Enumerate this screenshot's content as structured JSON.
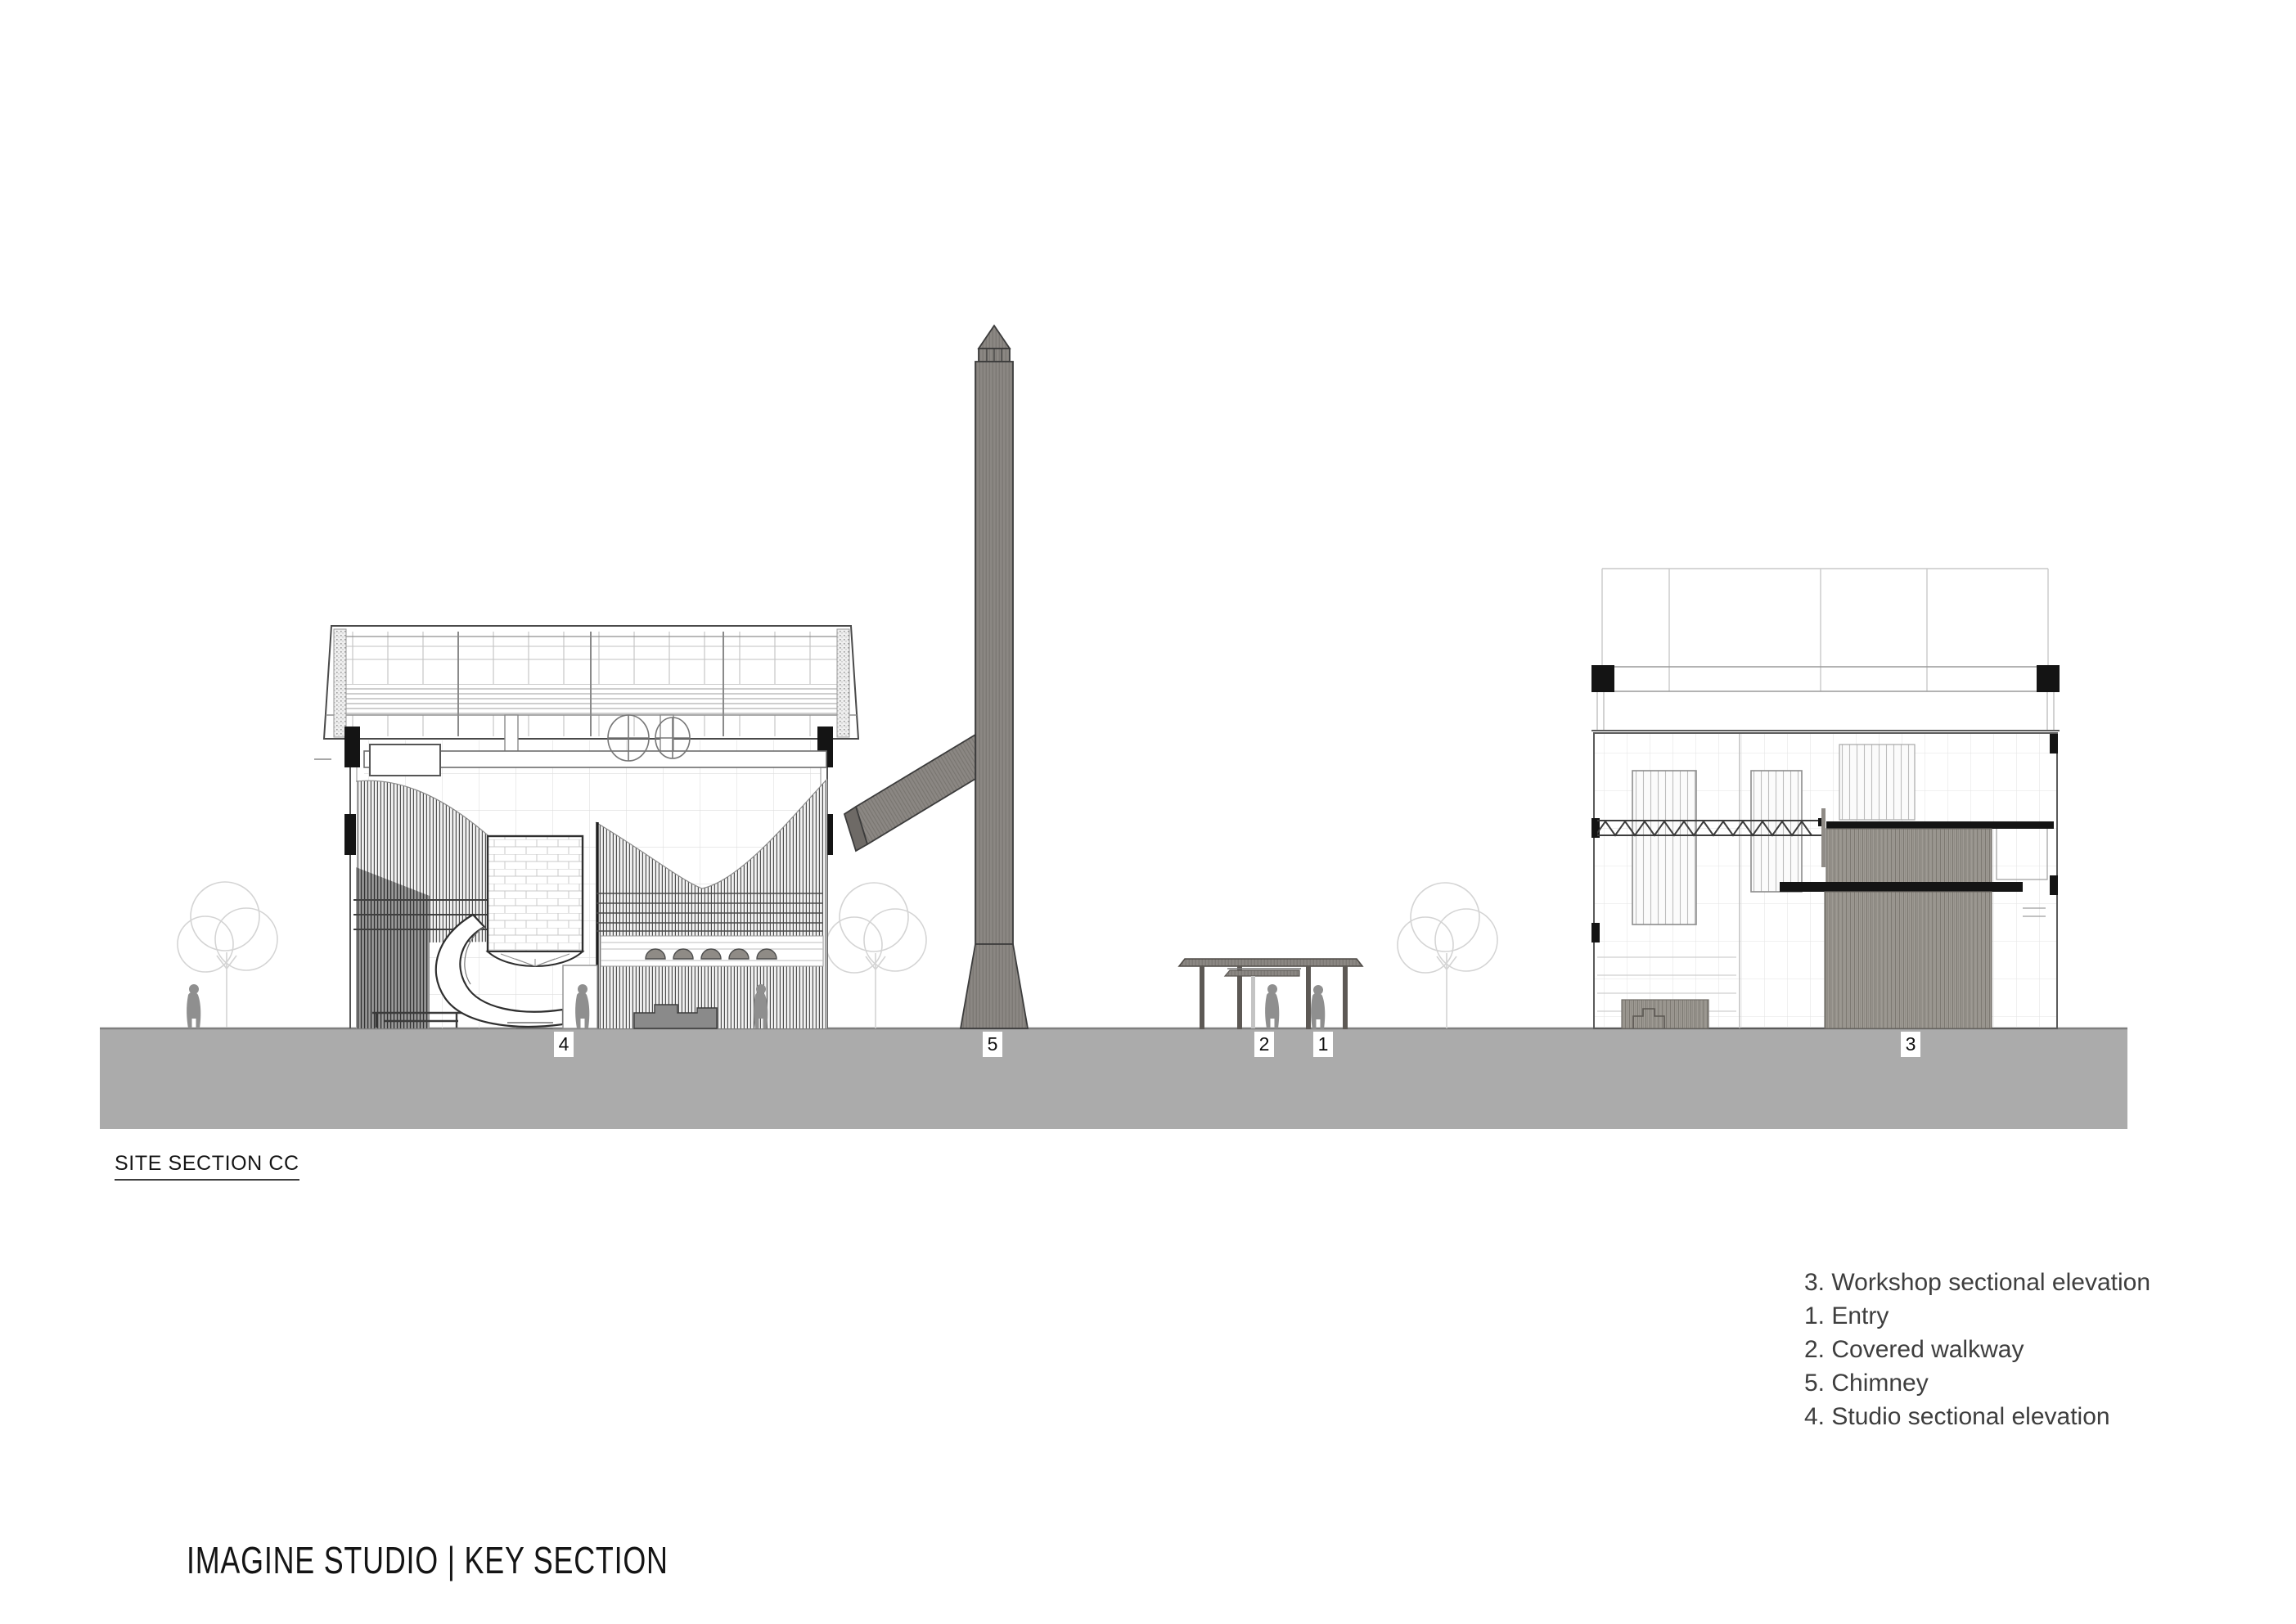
{
  "drawing_label": "SITE SECTION CC",
  "sheet_title": "IMAGINE STUDIO | KEY SECTION",
  "legend": {
    "items": [
      {
        "text": "3. Workshop sectional elevation"
      },
      {
        "text": "1. Entry"
      },
      {
        "text": "2. Covered walkway"
      },
      {
        "text": "5. Chimney"
      },
      {
        "text": "4. Studio sectional elevation"
      }
    ]
  },
  "markers": [
    {
      "number": "4",
      "refers_to": "Studio sectional elevation"
    },
    {
      "number": "5",
      "refers_to": "Chimney"
    },
    {
      "number": "2",
      "refers_to": "Covered walkway"
    },
    {
      "number": "1",
      "refers_to": "Entry"
    },
    {
      "number": "3",
      "refers_to": "Workshop sectional elevation"
    }
  ],
  "colors": {
    "ground": "#ababab",
    "chimney_fill": "#8b8783",
    "corrugation_fill": "#9e9a93",
    "silhouette": "#8f8f8f",
    "line_dark": "#3c3c3c",
    "grid_light": "#dedede"
  }
}
